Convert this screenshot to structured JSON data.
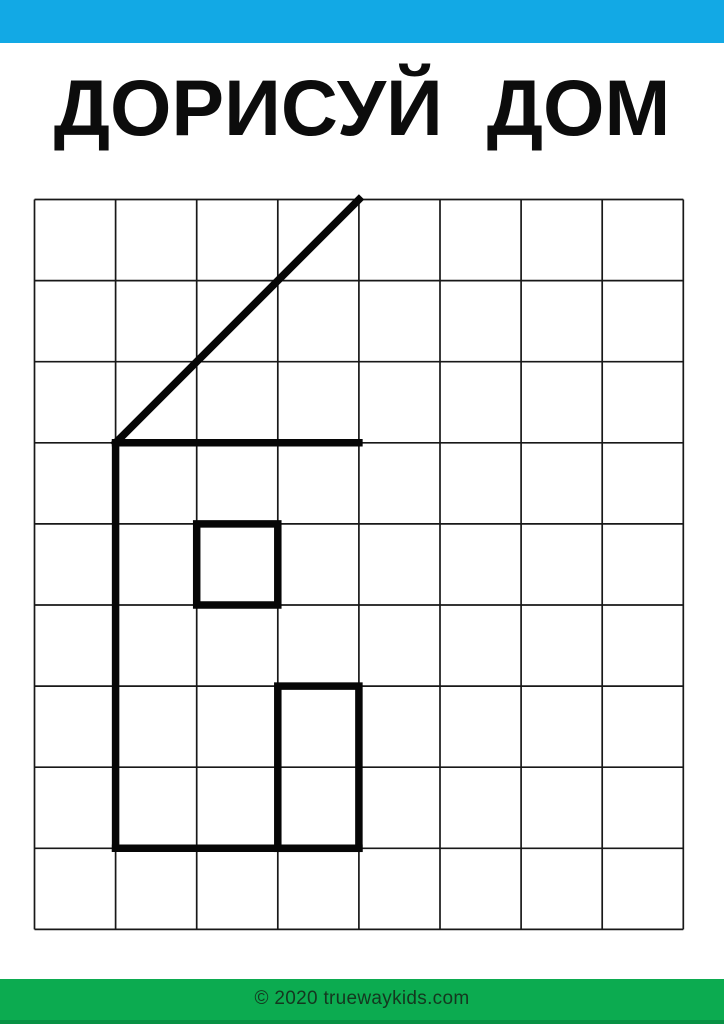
{
  "page": {
    "width": 724,
    "height": 1024,
    "background_color": "#ffffff"
  },
  "header": {
    "bar_color": "#12a9e5",
    "bar_height": 43
  },
  "title": {
    "text": "ДОРИСУЙ  ДОМ",
    "color": "#0c0c0c"
  },
  "worksheet": {
    "grid": {
      "x": 34.5,
      "y": 199.5,
      "cols": 8,
      "rows": 9,
      "cell_size": 81.1,
      "line_color": "#181818",
      "line_width": 1.7
    },
    "house": {
      "stroke_color": "#060606",
      "stroke_width": 7.5,
      "segments": [
        {
          "name": "roof-diagonal-line",
          "from": [
            1,
            3
          ],
          "to": [
            4,
            0
          ]
        },
        {
          "name": "roof-base-line",
          "from": [
            1,
            3
          ],
          "to": [
            4,
            3
          ]
        },
        {
          "name": "left-wall-line",
          "from": [
            1,
            3
          ],
          "to": [
            1,
            8
          ]
        },
        {
          "name": "floor-line",
          "from": [
            1,
            8
          ],
          "to": [
            4,
            8
          ]
        }
      ],
      "rects": [
        {
          "name": "window-square",
          "from": [
            2,
            4
          ],
          "to": [
            3,
            5
          ]
        },
        {
          "name": "door-rectangle",
          "from": [
            3,
            6
          ],
          "to": [
            4,
            8
          ]
        }
      ]
    }
  },
  "footer": {
    "bar_color": "#0cab50",
    "bar_edge_color": "#089144",
    "text": "© 2020 truewaykids.com",
    "text_color": "#14371f"
  }
}
